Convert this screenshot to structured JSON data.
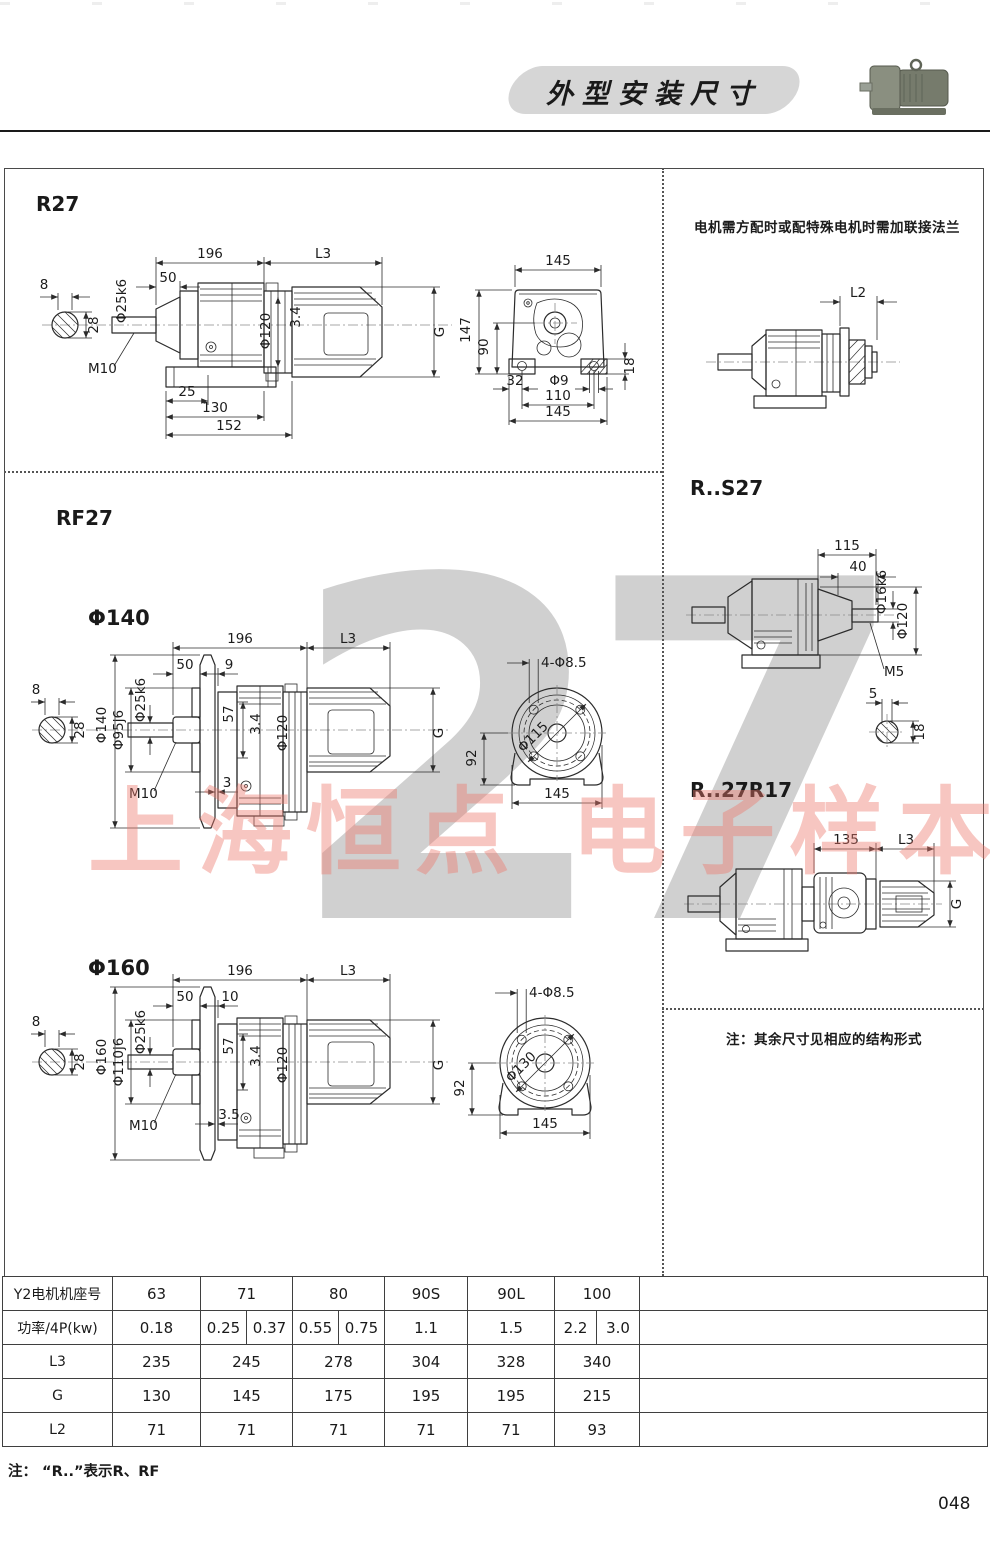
{
  "header": {
    "title": "外型安装尺寸",
    "product_image": "gear-motor-photo"
  },
  "watermark": {
    "big_digits": "27",
    "pink_text": "上海恒点 电子样本"
  },
  "r27": {
    "title": "R27",
    "side": {
      "len196": "196",
      "len_l3": "L3",
      "len50": "50",
      "shaft_dia": "Φ25k6",
      "key_w": "8",
      "key_h": "28",
      "thread": "M10",
      "dia120": "Φ120",
      "gap34": "3.4",
      "motor_g": "G",
      "foot25": "25",
      "foot130": "130",
      "foot152": "152"
    },
    "front": {
      "top145": "145",
      "h147": "147",
      "h90": "90",
      "h18": "18",
      "w32": "32",
      "hole": "Φ9",
      "w110": "110",
      "bot145": "145"
    }
  },
  "right_col": {
    "flange_note": "电机需方配时或配特殊电机时需加联接法兰",
    "l2_label": "L2",
    "rs27": {
      "title": "R..S27",
      "len115": "115",
      "len40": "40",
      "shaft_dia": "Φ16k6",
      "dia120": "Φ120",
      "thread": "M5",
      "key_w": "5",
      "key_h": "18"
    },
    "r27r17": {
      "title": "R..27R17",
      "len135": "135",
      "len_l3": "L3",
      "motor_g": "G"
    },
    "struct_note": "注：其余尺寸见相应的结构形式"
  },
  "rf27": {
    "title": "RF27",
    "f140": {
      "label": "Φ140",
      "len196": "196",
      "len_l3": "L3",
      "len50": "50",
      "len_gap": "9",
      "key_w": "8",
      "key_h": "28",
      "flange_dia": "Φ140",
      "spigot_dia": "Φ95j6",
      "shaft_dia": "Φ25k6",
      "d57": "57",
      "gap34": "3.4",
      "dia120": "Φ120",
      "motor_g": "G",
      "thread": "M10",
      "offset": "3",
      "holes": "4-Φ8.5",
      "bolt_circle": "Φ115",
      "h92": "92",
      "w145": "145"
    },
    "f160": {
      "label": "Φ160",
      "len196": "196",
      "len_l3": "L3",
      "len50": "50",
      "len_gap": "10",
      "key_w": "8",
      "key_h": "28",
      "flange_dia": "Φ160",
      "spigot_dia": "Φ110j6",
      "shaft_dia": "Φ25k6",
      "d57": "57",
      "gap34": "3.4",
      "dia120": "Φ120",
      "motor_g": "G",
      "thread": "M10",
      "offset": "3.5",
      "holes": "4-Φ8.5",
      "bolt_circle": "Φ130",
      "h92": "92",
      "w145": "145"
    }
  },
  "table": {
    "rows": [
      {
        "label": "Y2电机机座号",
        "cells": [
          "63",
          "71",
          "80",
          "90S",
          "90L",
          "100",
          ""
        ]
      },
      {
        "label": "功率/4P(kw)",
        "cells": [
          "0.18",
          "0.25",
          "0.37",
          "0.55",
          "0.75",
          "1.1",
          "1.5",
          "2.2",
          "3.0",
          ""
        ]
      },
      {
        "label": "L3",
        "cells": [
          "235",
          "245",
          "278",
          "304",
          "328",
          "340",
          ""
        ]
      },
      {
        "label": "G",
        "cells": [
          "130",
          "145",
          "175",
          "195",
          "195",
          "215",
          ""
        ]
      },
      {
        "label": "L2",
        "cells": [
          "71",
          "71",
          "71",
          "71",
          "71",
          "93",
          ""
        ]
      }
    ]
  },
  "footer": {
    "note": "注： “R..”表示R、RF",
    "page_number": "048"
  }
}
